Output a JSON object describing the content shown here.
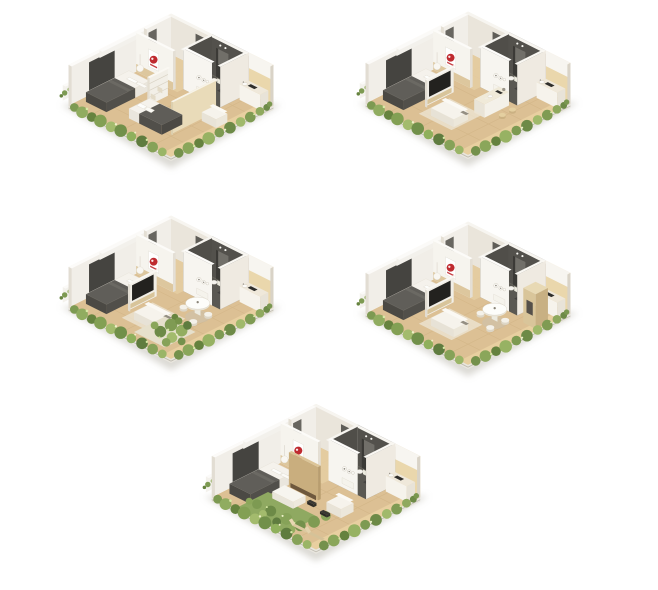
{
  "board": {
    "width": 658,
    "height": 590,
    "background": "#ffffff",
    "description": "Five isometric 3D floor-plan renderings of small apartment unit variants arranged in a 2-2-1 grid on a white background"
  },
  "palette": {
    "floor_wood": "#dcc094",
    "wall_white": "#f1eee8",
    "wall_shade": "#eae6dc",
    "bathroom_dark": "#53514c",
    "bedding_dark": "#5f5d58",
    "greenery_green": "#7f9b53",
    "wood_accent": "#c9ae7e",
    "brand_red": "#bf2a2f",
    "shadow": "#b7b4a9"
  },
  "logo": {
    "name": "red-circle-brand-plaque",
    "shape": "white wall plaque with red circular emblem and small red text line"
  },
  "units": [
    {
      "name": "floorplan-unit-1",
      "position": "top-left",
      "variant": "two-bedroom-with-wardrobe",
      "x": 55,
      "y": 4,
      "w": 232,
      "features": [
        "wardrobe",
        "bed2",
        "green"
      ]
    },
    {
      "name": "floorplan-unit-2",
      "position": "top-right",
      "variant": "one-bedroom-kitchen-island",
      "x": 352,
      "y": 2,
      "w": 232,
      "features": [
        "island",
        "sofa-tv",
        "green"
      ]
    },
    {
      "name": "floorplan-unit-3",
      "position": "middle-left",
      "variant": "one-bedroom-dining-indoor-garden",
      "x": 55,
      "y": 206,
      "w": 232,
      "features": [
        "sofa-tv",
        "round-table",
        "plants",
        "green"
      ]
    },
    {
      "name": "floorplan-unit-4",
      "position": "middle-right",
      "variant": "one-bedroom-dining-wood-cabinet",
      "x": 352,
      "y": 212,
      "w": 232,
      "features": [
        "cabinet",
        "sofa-tv",
        "round-table",
        "green"
      ]
    },
    {
      "name": "floorplan-unit-5",
      "position": "bottom-center",
      "variant": "one-bedroom-terrace-garden",
      "x": 198,
      "y": 394,
      "w": 236,
      "features": [
        "wood-wall",
        "garden-wide",
        "terrace",
        "green"
      ]
    }
  ]
}
